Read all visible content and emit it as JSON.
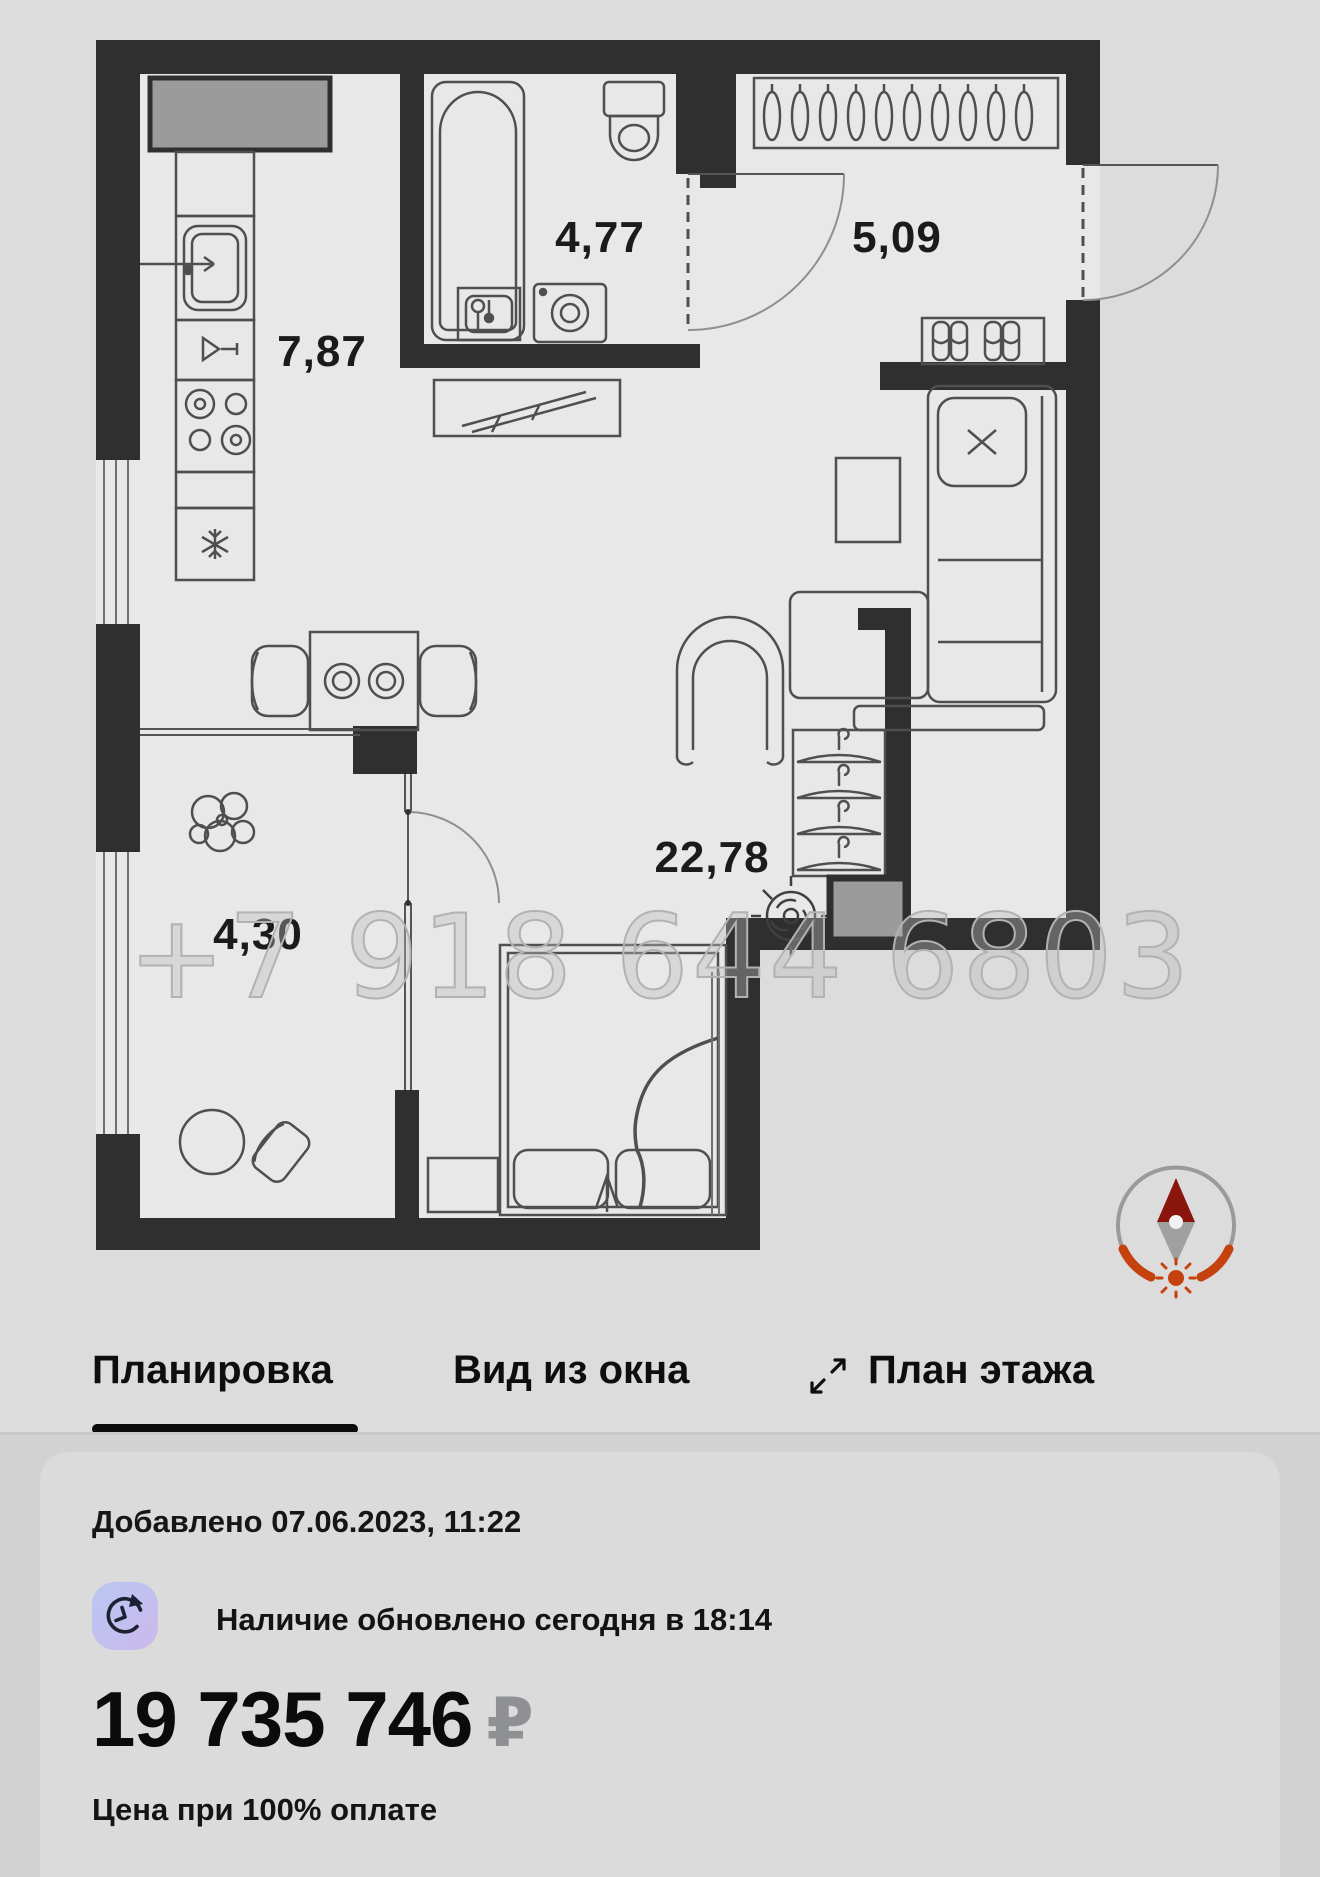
{
  "floor_plan": {
    "watermark": "+7 918 644 6803",
    "rooms": [
      {
        "id": "kitchen",
        "area": "7,87"
      },
      {
        "id": "bathroom",
        "area": "4,77"
      },
      {
        "id": "hallway",
        "area": "5,09"
      },
      {
        "id": "living_room",
        "area": "22,78"
      },
      {
        "id": "balcony",
        "area": "4,30"
      }
    ]
  },
  "tabs": {
    "layout": "Планировка",
    "window_view": "Вид из окна",
    "floor_plan_tab": "План этажа"
  },
  "listing": {
    "added": "Добавлено 07.06.2023, 11:22",
    "availability": "Наличие обновлено сегодня в 18:14",
    "price": "19 735 746",
    "currency": "₽",
    "price_note": "Цена при 100% оплате"
  },
  "colors": {
    "wall": "#2f2f2f",
    "compass_accent": "#c5410e",
    "icon_bg_start": "#bac7f1",
    "icon_bg_end": "#cdb9ec"
  }
}
